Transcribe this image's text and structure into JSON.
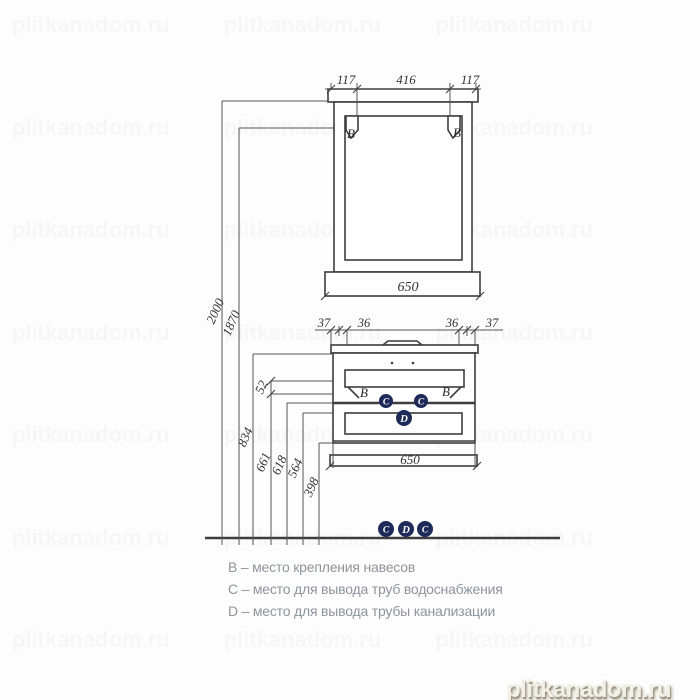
{
  "drawing": {
    "heights": {
      "h2000": "2000",
      "h1870": "1870",
      "h834": "834",
      "h661": "661",
      "h618": "618",
      "h564": "564",
      "h398": "398",
      "h52": "52"
    },
    "mirror": {
      "top_dim_left": "117",
      "top_dim_center": "416",
      "top_dim_right": "117",
      "width": "650",
      "bracket_left": "B",
      "bracket_right": "B"
    },
    "vanity": {
      "top_dim_1": "37",
      "top_dim_2": "36",
      "top_dim_3": "36",
      "top_dim_4": "37",
      "width": "650",
      "bracket_left": "B",
      "bracket_right": "B",
      "supply_left": "C",
      "supply_right": "C",
      "drain": "D",
      "floor_markers": [
        "C",
        "D",
        "C"
      ]
    }
  },
  "legend": {
    "line_b": "B – место крепления навесов",
    "line_c": "C – место для вывода труб водоснабжения",
    "line_d": "D – место для вывода трубы канализации"
  },
  "watermark": {
    "text": "plitkanadom.ru",
    "tile_count": 21
  },
  "colors": {
    "line": "#555555",
    "object": "#3d3d3d",
    "marker": "#1e2a5a",
    "marker_letter": "#ffffff",
    "legend_text": "#8e949c",
    "watermark_text": "#f2f0e6"
  }
}
